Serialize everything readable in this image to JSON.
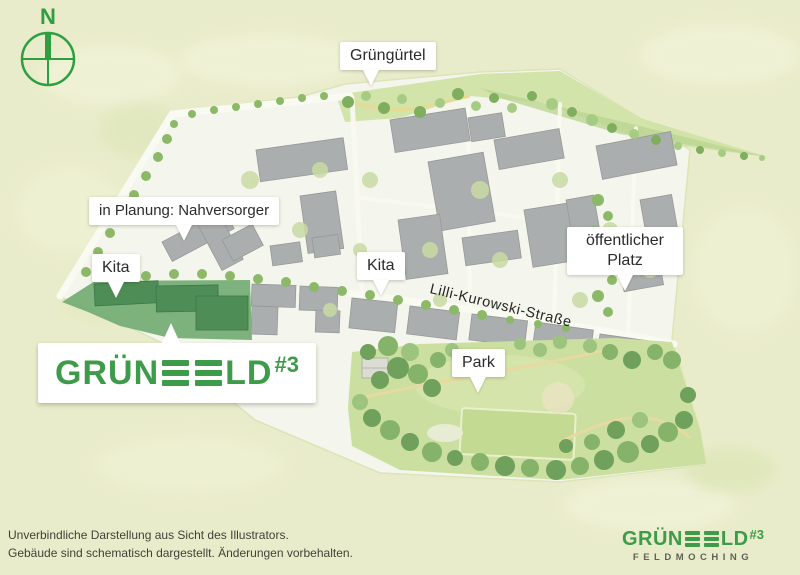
{
  "map": {
    "compass": {
      "label": "N"
    },
    "callouts": [
      {
        "id": "gruenguertel",
        "text": "Grüngürtel"
      },
      {
        "id": "nahversorger",
        "text": "in Planung: Nahversorger"
      },
      {
        "id": "kita-west",
        "text": "Kita"
      },
      {
        "id": "kita-mitte",
        "text": "Kita"
      },
      {
        "id": "oeffentlicher-platz",
        "text": "öffentlicher Platz"
      },
      {
        "id": "park",
        "text": "Park"
      }
    ],
    "street_label": "Lilli-Kurowski-Straße"
  },
  "logo": {
    "part1": "GRÜN",
    "part2": "LD",
    "suffix": "#3",
    "subtitle": "FELDMOCHING"
  },
  "footer": {
    "line1": "Unverbindliche Darstellung aus Sicht des Illustrators.",
    "line2": "Gebäude sind schematisch dargestellt. Änderungen vorbehalten."
  },
  "colors": {
    "accent_green": "#3d9b49",
    "map_background": "#e9ecca",
    "site_area": "#f4f5ec",
    "development_green": "#77ae77",
    "building_gray": "#abaeae"
  }
}
